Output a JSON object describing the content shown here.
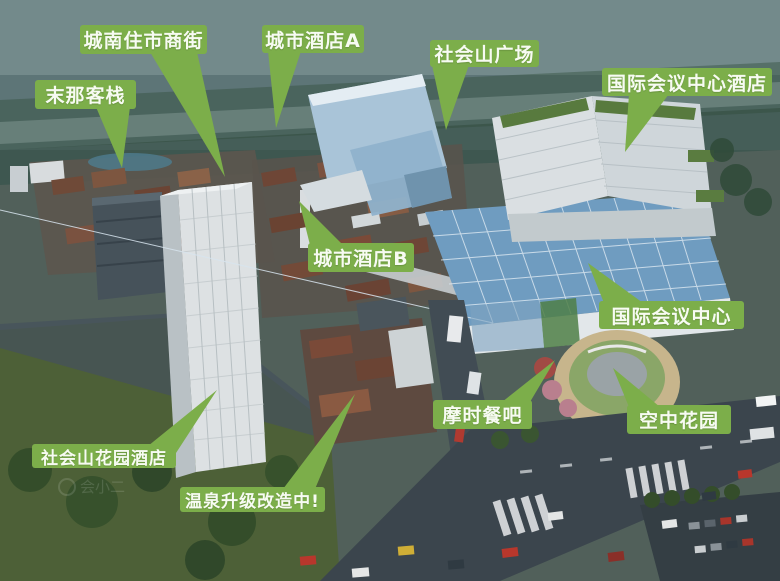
{
  "colors": {
    "label_background": "#7cae4a",
    "label_text": "#f7fbf2"
  },
  "watermark": {
    "text": "会小二"
  },
  "annotations": [
    {
      "id": "chengnan-resident-market-street",
      "text": "城南住市商街"
    },
    {
      "id": "city-hotel-a",
      "text": "城市酒店A"
    },
    {
      "id": "shehuishan-plaza",
      "text": "社会山广场"
    },
    {
      "id": "international-convention-center-hotel",
      "text": "国际会议中心酒店"
    },
    {
      "id": "mona-inn",
      "text": "末那客栈"
    },
    {
      "id": "city-hotel-b",
      "text": "城市酒店B"
    },
    {
      "id": "international-convention-center",
      "text": "国际会议中心"
    },
    {
      "id": "moshi-restaurant-bar",
      "text": "摩时餐吧"
    },
    {
      "id": "sky-garden",
      "text": "空中花园"
    },
    {
      "id": "shehuishan-garden-hotel",
      "text": "社会山花园酒店"
    },
    {
      "id": "hot-spring-upgrading",
      "text": "温泉升级改造中!"
    }
  ]
}
